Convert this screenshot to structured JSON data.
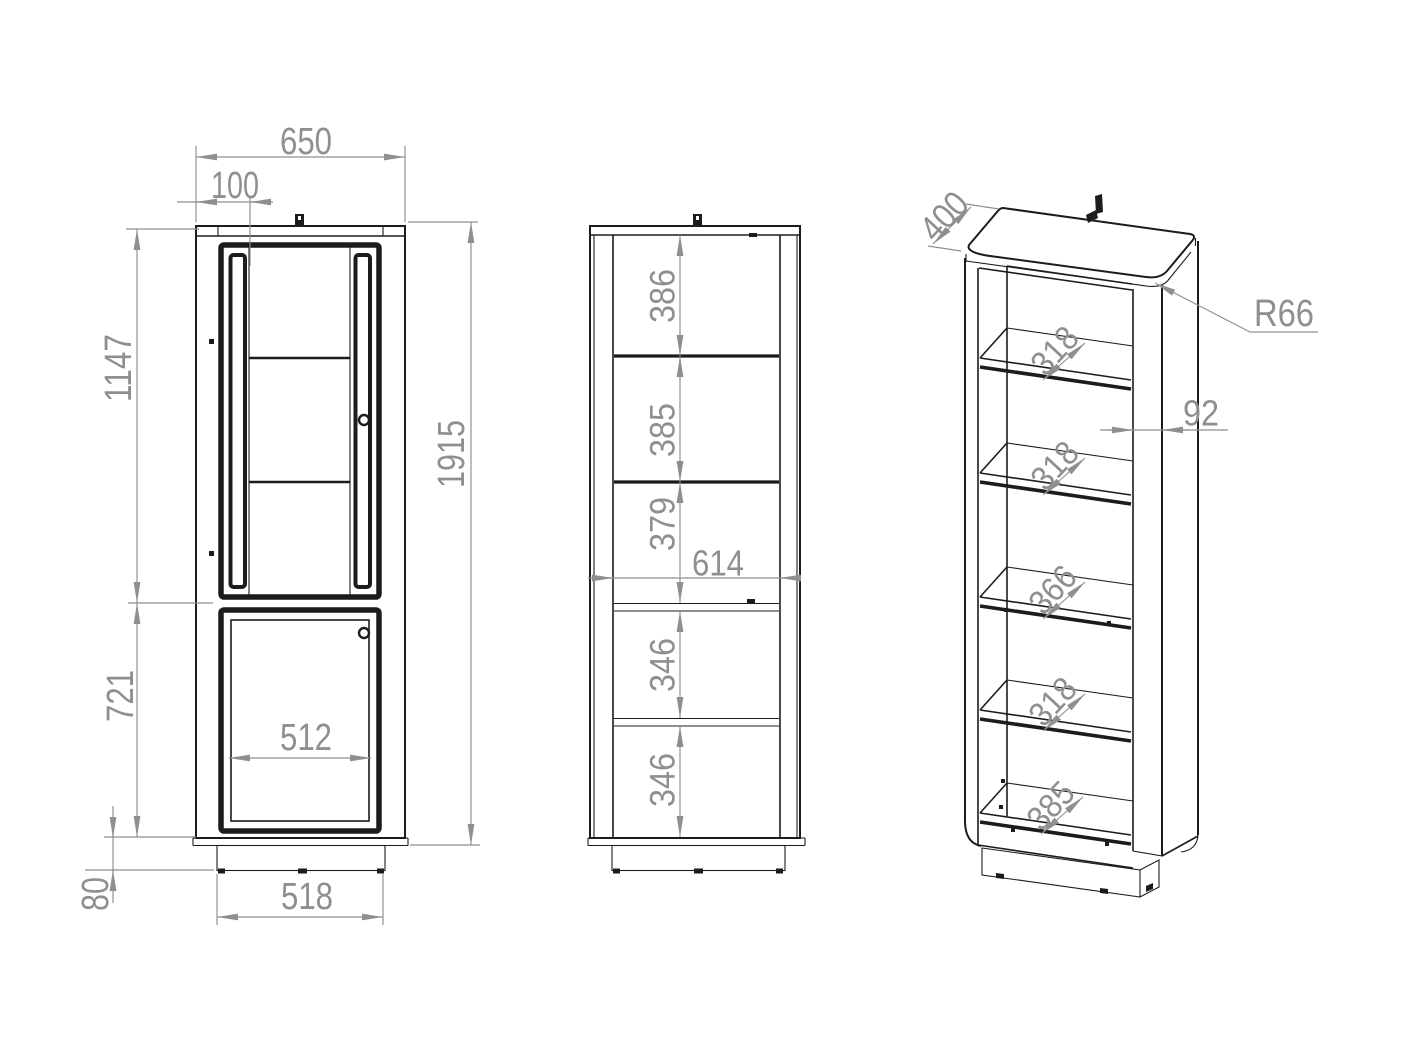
{
  "drawing": {
    "type": "furniture-technical-drawing",
    "colors": {
      "line": "#1c1c1c",
      "dimension": "#8f8f8f",
      "background": "#ffffff"
    }
  },
  "views": {
    "front": {
      "top_width": "650",
      "glass_offset": "100",
      "upper_door_height": "1147",
      "total_height": "1915",
      "lower_door_height": "721",
      "plinth_height": "80",
      "lower_door_width": "512",
      "base_width": "518"
    },
    "middle": {
      "gap1": "386",
      "gap2": "385",
      "gap3": "379",
      "inner_width": "614",
      "gap4": "346",
      "gap5": "346"
    },
    "iso": {
      "depth": "400",
      "corner_radius": "R66",
      "front_post_width": "92",
      "shelf_depths": [
        "318",
        "318",
        "366",
        "318",
        "385"
      ]
    }
  }
}
